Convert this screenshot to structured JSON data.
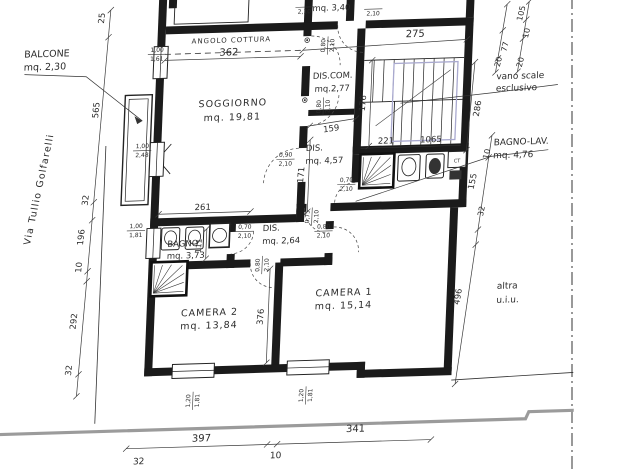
{
  "canvas": {
    "width": 620,
    "height": 473
  },
  "colors": {
    "background": "#ffffff",
    "wall_ink": "#1b1b1b",
    "line_ink": "#3a3a3a",
    "text_ink": "#2b2b2b",
    "stair_overlay": "#a9a9cf",
    "street_edge_gray": "#9b9b9b"
  },
  "rooms": {
    "balcone": {
      "label": "BALCONE",
      "area": "mq. 2,30"
    },
    "soggiorno": {
      "label": "SOGGIORNO",
      "area": "mq. 19,81"
    },
    "angolo_cottura": {
      "label": "ANGOLO COTTURA"
    },
    "dis_com": {
      "label": "DIS.COM.",
      "area": "mq.2,77"
    },
    "vano_scale": {
      "label": "vano scale esclusivo"
    },
    "dis_grande": {
      "label": "DIS.",
      "area": "mq. 4,57"
    },
    "bagno_lav": {
      "label": "BAGNO-LAV.",
      "area": "mq. 4,76"
    },
    "bagno": {
      "label": "BAGNO",
      "area": "mq. 3,73"
    },
    "dis_piccolo": {
      "label": "DIS.",
      "area": "mq. 2,64"
    },
    "camera1": {
      "label": "CAMERA 1",
      "area": "mq. 15,14"
    },
    "camera2": {
      "label": "CAMERA 2",
      "area": "mq. 13,84"
    },
    "altra_unita": {
      "label": "altra u.i.u."
    },
    "piano_sopra": {
      "area": "mq. 3,40"
    },
    "caldaia": {
      "label": "CT"
    }
  },
  "street": {
    "name": "Via Tullio Golfarelli"
  },
  "labels": [
    {
      "name": "label-balcone",
      "x": 17,
      "y": 49,
      "anchor": "start",
      "size": 9.5,
      "lh": 13,
      "lines": [
        "BALCONE",
        "mq. 2,30"
      ]
    },
    {
      "name": "label-street-via-tullio-golfarelli",
      "x": 40,
      "y": 182,
      "rot": -80,
      "size": 9.5,
      "ls": 1.2,
      "text": "Via Tullio Golfarelli"
    },
    {
      "name": "dim-25",
      "x": 96,
      "y": 12,
      "rot": -86,
      "size": 8.5,
      "text": "25"
    },
    {
      "name": "dim-565",
      "x": 94,
      "y": 104,
      "rot": -86,
      "size": 8.5,
      "text": "565"
    },
    {
      "name": "dim-32-left-upper",
      "x": 87,
      "y": 194,
      "rot": -86,
      "size": 8.5,
      "text": "32"
    },
    {
      "name": "dim-196",
      "x": 84,
      "y": 231,
      "rot": -86,
      "size": 8.5,
      "text": "196"
    },
    {
      "name": "dim-10-left",
      "x": 83,
      "y": 261,
      "rot": -86,
      "size": 8.5,
      "text": "10"
    },
    {
      "name": "dim-292",
      "x": 80,
      "y": 315,
      "rot": -86,
      "size": 8.5,
      "text": "292"
    },
    {
      "name": "dim-32-left-lower",
      "x": 77,
      "y": 364,
      "rot": -86,
      "size": 8.5,
      "text": "32"
    },
    {
      "name": "label-angolo-cottura",
      "x": 224,
      "y": 40,
      "size": 7,
      "ls": 1,
      "text": "ANGOLO COTTURA"
    },
    {
      "name": "dim-362",
      "x": 222,
      "y": 53,
      "size": 10,
      "text": "362"
    },
    {
      "name": "opening-100-161",
      "x": 150,
      "y": 49,
      "size": 6,
      "frac": {
        "top": "1,00",
        "bottom": "1,61"
      }
    },
    {
      "name": "label-soggiorno",
      "x": 228,
      "y": 104,
      "size": 9.5,
      "lh": 14,
      "ls": 1,
      "lines": [
        "SOGGIORNO",
        "mq. 19,81"
      ]
    },
    {
      "name": "opening-210-a",
      "x": 296,
      "y": 6,
      "size": 6,
      "frac": {
        "top": "",
        "bottom": "2,10"
      }
    },
    {
      "name": "label-mq-340",
      "x": 323,
      "y": 11,
      "size": 8.5,
      "text": "mq. 3,40"
    },
    {
      "name": "opening-210-b",
      "x": 365,
      "y": 10,
      "size": 6,
      "frac": {
        "top": "",
        "bottom": "2,10"
      }
    },
    {
      "name": "label-dis-com",
      "x": 327,
      "y": 79,
      "size": 8.5,
      "lh": 13,
      "lines": [
        "DIS.COM.",
        "mq.2,77"
      ]
    },
    {
      "name": "dim-275",
      "x": 408,
      "y": 40,
      "size": 10,
      "text": "275"
    },
    {
      "name": "opening-080-210-discom-upper",
      "x": 320,
      "y": 46,
      "rot": -90,
      "size": 6,
      "frac": {
        "top": "0,80",
        "bottom": "2,10"
      }
    },
    {
      "name": "opening-080-210-discom-lower",
      "x": 318,
      "y": 107,
      "rot": -90,
      "size": 6,
      "frac": {
        "top": "0,80",
        "bottom": "2,10"
      }
    },
    {
      "name": "dim-176",
      "x": 361,
      "y": 105,
      "rot": -87,
      "size": 8.5,
      "text": "176"
    },
    {
      "name": "dim-221",
      "x": 383,
      "y": 146,
      "size": 8.5,
      "text": "221"
    },
    {
      "name": "dim-1065",
      "x": 428,
      "y": 146,
      "size": 8.5,
      "text": "1065"
    },
    {
      "name": "label-vano-scale-esclusivo",
      "x": 491,
      "y": 85,
      "anchor": "start",
      "size": 9,
      "lh": 12,
      "lines": [
        "vano scale",
        "esclusivo"
      ]
    },
    {
      "name": "dim-286",
      "x": 476,
      "y": 114,
      "rot": -82,
      "size": 8.5,
      "text": "286"
    },
    {
      "name": "dim-105",
      "x": 516,
      "y": 20,
      "rot": -78,
      "size": 8,
      "text": "105"
    },
    {
      "name": "dim-10-topright",
      "x": 522,
      "y": 40,
      "rot": -78,
      "size": 8,
      "text": "10"
    },
    {
      "name": "dim-77",
      "x": 501,
      "y": 53,
      "rot": -78,
      "size": 8,
      "text": "77"
    },
    {
      "name": "dim-20-a",
      "x": 495,
      "y": 68,
      "rot": -78,
      "size": 8,
      "text": "20"
    },
    {
      "name": "dim-20-b",
      "x": 517,
      "y": 69,
      "rot": -78,
      "size": 8,
      "text": "20"
    },
    {
      "name": "dim-159",
      "x": 328,
      "y": 132,
      "rot": -7,
      "size": 8.5,
      "text": "159"
    },
    {
      "name": "label-dis-457",
      "x": 303,
      "y": 151,
      "anchor": "start",
      "size": 8.5,
      "lh": 13,
      "lines": [
        "DIS.",
        "mq. 4,57"
      ]
    },
    {
      "name": "dim-171",
      "x": 302,
      "y": 175,
      "rot": -87,
      "size": 8.5,
      "text": "171"
    },
    {
      "name": "opening-090-210",
      "x": 283,
      "y": 158,
      "size": 6,
      "frac": {
        "top": "0,90",
        "bottom": "2,10"
      }
    },
    {
      "name": "opening-070-210-bagnolav",
      "x": 345,
      "y": 185,
      "size": 6,
      "frac": {
        "top": "0,70",
        "bottom": "2,10"
      }
    },
    {
      "name": "label-bagno-lav",
      "x": 491,
      "y": 151,
      "anchor": "start",
      "size": 9,
      "lh": 13,
      "lines": [
        "BAGNO-LAV.",
        "mq. 4,76"
      ]
    },
    {
      "name": "dim-10-right",
      "x": 487,
      "y": 160,
      "rot": -78,
      "size": 8,
      "text": "10"
    },
    {
      "name": "dim-155",
      "x": 474,
      "y": 187,
      "rot": -80,
      "size": 8.5,
      "text": "155"
    },
    {
      "name": "dim-32-right",
      "x": 484,
      "y": 217,
      "rot": -80,
      "size": 8,
      "text": "32"
    },
    {
      "name": "dim-496",
      "x": 464,
      "y": 302,
      "rot": -82,
      "size": 8.5,
      "text": "496"
    },
    {
      "name": "label-altra-uiu",
      "x": 500,
      "y": 295,
      "anchor": "start",
      "size": 9,
      "lh": 14,
      "lines": [
        "altra",
        "u.i.u."
      ]
    },
    {
      "name": "dim-261",
      "x": 202,
      "y": 207,
      "size": 8.5,
      "text": "261"
    },
    {
      "name": "opening-075-210",
      "x": 311,
      "y": 217,
      "rot": -90,
      "size": 6,
      "frac": {
        "top": "0,75",
        "bottom": "2,10"
      }
    },
    {
      "name": "label-bagno",
      "x": 168,
      "y": 243,
      "anchor": "start",
      "size": 8.5,
      "lh": 12,
      "lines": [
        "BAGNO",
        "mq. 3,73"
      ]
    },
    {
      "name": "dim-111",
      "x": 202,
      "y": 243,
      "rot": -87,
      "size": 7.5,
      "text": "111"
    },
    {
      "name": "opening-070-210-bagno",
      "x": 245,
      "y": 229,
      "size": 6,
      "frac": {
        "top": "0,70",
        "bottom": "2,10"
      }
    },
    {
      "name": "label-dis-264",
      "x": 263,
      "y": 230,
      "anchor": "start",
      "size": 8.5,
      "lh": 13,
      "lines": [
        "DIS.",
        "mq. 2,64"
      ]
    },
    {
      "name": "opening-080-210-camera1",
      "x": 324,
      "y": 231,
      "size": 6,
      "frac": {
        "top": "0,80",
        "bottom": "2,10"
      }
    },
    {
      "name": "opening-080-210-camera2",
      "x": 263,
      "y": 264,
      "rot": -90,
      "size": 6,
      "frac": {
        "top": "0,80",
        "bottom": "2,10"
      }
    },
    {
      "name": "label-camera1",
      "x": 347,
      "y": 297,
      "size": 9.5,
      "lh": 13,
      "ls": 1,
      "lines": [
        "CAMERA 1",
        "mq. 15,14"
      ]
    },
    {
      "name": "label-camera2",
      "x": 213,
      "y": 313,
      "size": 9.5,
      "lh": 13,
      "ls": 1,
      "lines": [
        "CAMERA 2",
        "mq. 13,84"
      ]
    },
    {
      "name": "dim-376",
      "x": 267,
      "y": 316,
      "rot": -87,
      "size": 8.5,
      "text": "376"
    },
    {
      "name": "opening-120-181-camera2",
      "x": 199,
      "y": 398,
      "rot": -90,
      "size": 6,
      "frac": {
        "top": "1,20",
        "bottom": "1,81"
      }
    },
    {
      "name": "opening-120-181-camera1",
      "x": 312,
      "y": 396,
      "rot": -90,
      "size": 6,
      "frac": {
        "top": "1,20",
        "bottom": "1,81"
      }
    },
    {
      "name": "dim-397",
      "x": 210,
      "y": 439,
      "size": 10,
      "text": "397"
    },
    {
      "name": "dim-341",
      "x": 364,
      "y": 434,
      "size": 10,
      "text": "341"
    },
    {
      "name": "dim-32-bottom",
      "x": 148,
      "y": 460,
      "size": 9,
      "text": "32"
    },
    {
      "name": "dim-10-bottom",
      "x": 285,
      "y": 458,
      "size": 9,
      "text": "10"
    },
    {
      "name": "opening-100-248",
      "x": 139,
      "y": 145,
      "size": 6,
      "frac": {
        "top": "1,00",
        "bottom": "2,48"
      }
    },
    {
      "name": "opening-100-181",
      "x": 136,
      "y": 225,
      "size": 6,
      "frac": {
        "top": "1,00",
        "bottom": "1,81"
      }
    },
    {
      "name": "label-ct",
      "x": 455,
      "y": 167,
      "size": 5,
      "text": "CT"
    }
  ]
}
